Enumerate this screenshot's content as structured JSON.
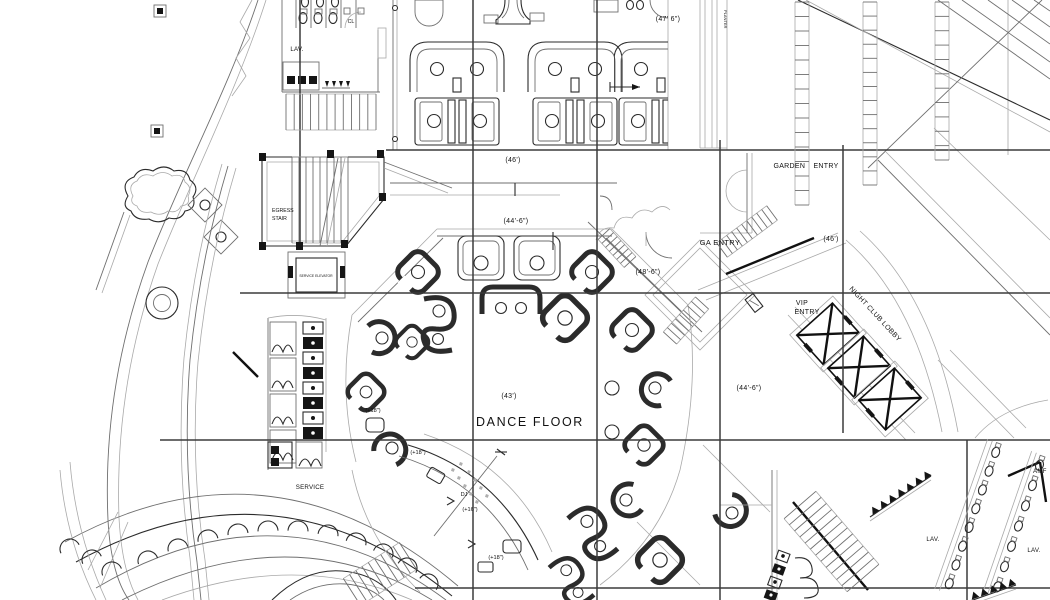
{
  "colors": {
    "background": "#ffffff",
    "line_dark": "#2b2b2b",
    "line_mid": "#6f6f6f",
    "line_light": "#a9a9a9",
    "grid_line": "#3b3b3b",
    "text": "#111111"
  },
  "labels": {
    "lav_top": "LAV.",
    "closet": "CL",
    "dim_top_47_6": "(47' 6\")",
    "planter": "PLANTER",
    "garden_entry": "GARDEN ENTRY",
    "dim_right_46": "(46')",
    "ga_entry": "GA ENTRY",
    "dim_48_6": "(48'-6\")",
    "vip_entry_line1": "VIP",
    "vip_entry_line2": "ENTRY",
    "night_club_lobby": "NIGHT CLUB LOBBY",
    "dim_mid_46": "(46')",
    "dim_mid_44_6": "(44'-6\")",
    "dim_43": "(43')",
    "dance_floor": "DANCE FLOOR",
    "dim_low_44_6": "(44'-6\")",
    "egress_stair_line1": "EGRESS",
    "egress_stair_line2": "STAIR",
    "service_elevator": "SERVICE ELEVATOR",
    "service": "SERVICE",
    "platform_18_left": "(+18\")",
    "platform_18_dj_top": "(+18\")",
    "dj": "DJ",
    "platform_16_dj": "(+16\")",
    "platform_18_lower": "(+18\")",
    "lav_right_inner": "LAV.",
    "lav_right_outer": "LAV.",
    "amf_clipped": "AMF"
  }
}
